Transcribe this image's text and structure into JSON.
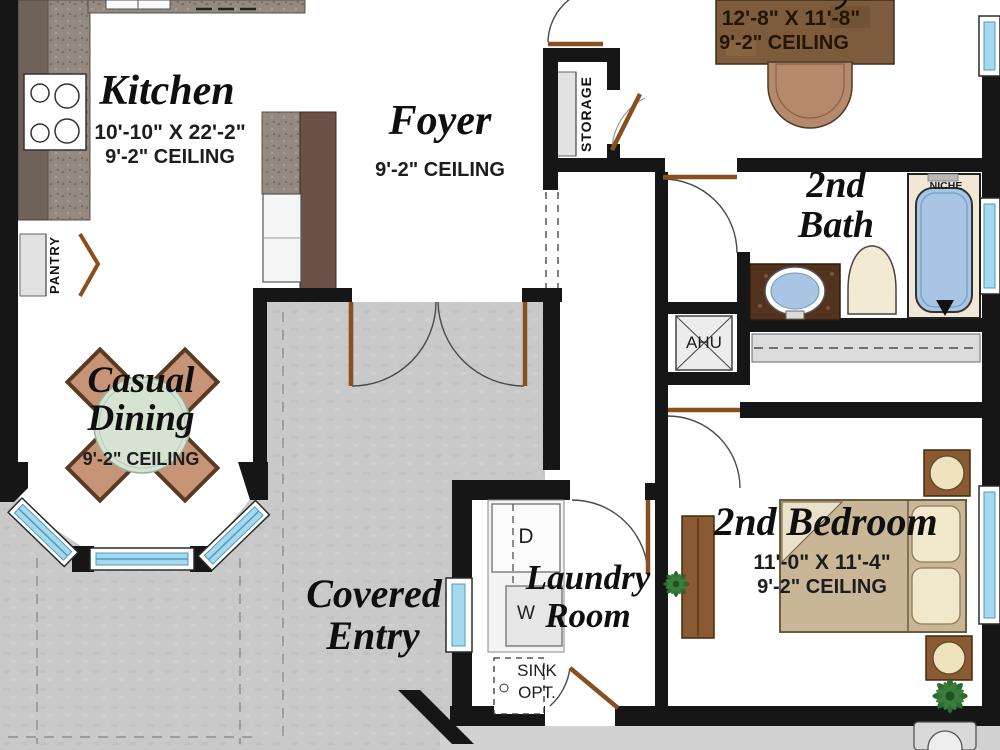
{
  "rooms": {
    "kitchen": {
      "name": "Kitchen",
      "dimensions": "10'-10\" X 22'-2\"",
      "ceiling": "9'-2\" CEILING"
    },
    "foyer": {
      "name": "Foyer",
      "ceiling": "9'-2\" CEILING"
    },
    "den": {
      "dimensions": "12'-8\" X 11'-8\"",
      "ceiling": "9'-2\" CEILING"
    },
    "casual_dining": {
      "name_line1": "Casual",
      "name_line2": "Dining",
      "ceiling": "9'-2\" CEILING"
    },
    "covered_entry": {
      "name_line1": "Covered",
      "name_line2": "Entry"
    },
    "laundry": {
      "name_line1": "Laundry",
      "name_line2": "Room"
    },
    "second_bath": {
      "name_line1": "2nd",
      "name_line2": "Bath"
    },
    "second_bedroom": {
      "name": "2nd Bedroom",
      "dimensions": "11'-0\" X 11'-4\"",
      "ceiling": "9'-2\" CEILING"
    }
  },
  "labels": {
    "storage": "STORAGE",
    "pantry": "PANTRY",
    "ahu": "AHU",
    "niche": "NICHE",
    "dryer": "D",
    "washer": "W",
    "sink_line1": "SINK",
    "sink_line2": "OPT."
  },
  "colors": {
    "wall": "#161616",
    "paving": "#c9c9c9",
    "walk": "#d2d2d2",
    "window_blue": "#a6d9ee",
    "door_wood": "#8a4f1f",
    "counter_granite": "#958a81",
    "counter_dark": "#6f6258",
    "cabinet_brown": "#6b5146",
    "desk_brown": "#7d5c3d",
    "chair_tan": "#b58a6c",
    "dining_chair": "#c89478",
    "table_green": "#d6e3d3",
    "fixture_blue": "#a9c5e6",
    "vanity_brown": "#53321f",
    "bed_tan": "#c9b697",
    "pillow_cream": "#f2e9cd",
    "nightstand_brown": "#8a5a33",
    "plant_green": "#2e6f2f",
    "tub_floor_cream": "#f0e8d4"
  }
}
